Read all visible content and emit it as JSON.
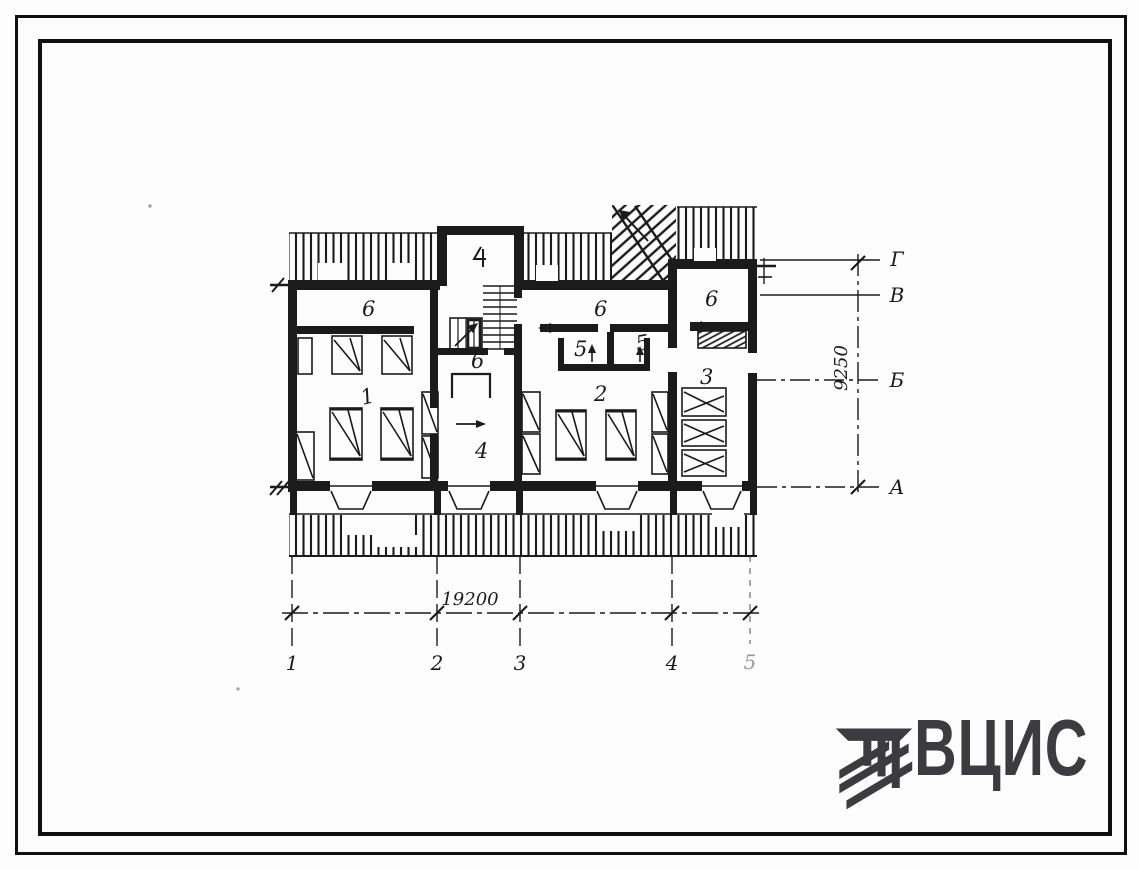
{
  "colors": {
    "ink": "#1b1b1b",
    "paper": "#fdfdfd",
    "logo": "#3b3b40"
  },
  "plan": {
    "room_labels": [
      "6",
      "6",
      "6",
      "6",
      "5",
      "5",
      "3",
      "1",
      "2",
      "4"
    ],
    "axis_bottom": [
      "1",
      "2",
      "3",
      "4",
      "5"
    ],
    "axis_right": [
      "Г",
      "В",
      "Б",
      "А"
    ],
    "dim_horizontal": "19200",
    "dim_vertical": "9250"
  },
  "logo": {
    "text": "ВЦИС",
    "icon": "hatched-beam-mark-icon"
  }
}
